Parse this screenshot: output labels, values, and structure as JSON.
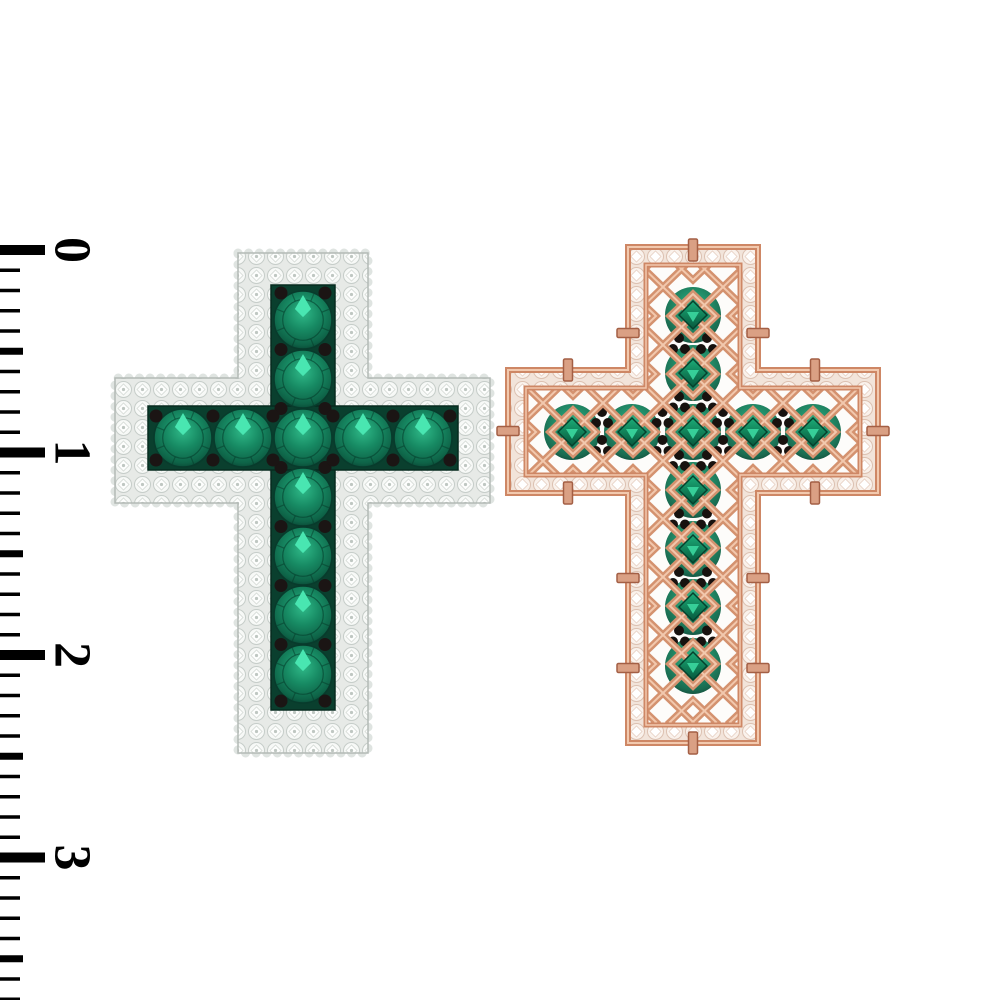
{
  "meta": {
    "description": "3D product render of a cross pendant shown front and back beside a vertical centimeter ruler on a white background",
    "canvas": {
      "width": 1000,
      "height": 1000,
      "background": "#ffffff"
    }
  },
  "ruler": {
    "labels": [
      "0",
      "1",
      "2",
      "3"
    ],
    "label_y": [
      250,
      452.5,
      655,
      857.5
    ],
    "origin_y": 250,
    "mm_px": 20.25,
    "tick_count": 38,
    "major_len": 45,
    "half_len": 23,
    "minor_len": 20,
    "major_h": 10,
    "half_h": 7,
    "minor_h": 3.5,
    "color": "#000000"
  },
  "front_cross": {
    "name": "white-gold pave cross with emeralds and black diamond accents (front view)",
    "pave_color": "#e7eae7",
    "channel_color": "#0a3f2e",
    "bead_color": "#1b1514",
    "emerald_color": "#178a63",
    "emerald_radius": 29,
    "stone_count": 11,
    "vertical_stones": {
      "x": 303,
      "ys": [
        320,
        379,
        438,
        497,
        556,
        615,
        674
      ]
    },
    "horizontal_stones": {
      "y": 438,
      "xs": [
        183,
        243,
        303,
        363,
        423
      ]
    }
  },
  "back_cross": {
    "name": "rose-gold openwork filigree cross (back view) with emeralds visible through lattice windows",
    "metal_mid": "#ce8765",
    "metal_light": "#f2c9ae",
    "metal_dark": "#a35f45",
    "emerald_radius": 28,
    "stone_count": 11,
    "vertical_stones": {
      "x": 693,
      "ys": [
        315,
        373,
        432,
        490,
        549,
        607,
        666
      ]
    },
    "horizontal_stones": {
      "y": 432,
      "xs": [
        572,
        632,
        693,
        753,
        813
      ]
    },
    "tabs": [
      {
        "x": 693,
        "y": 250,
        "o": "v"
      },
      {
        "x": 628,
        "y": 333,
        "o": "h"
      },
      {
        "x": 758,
        "y": 333,
        "o": "h"
      },
      {
        "x": 568,
        "y": 370,
        "o": "v"
      },
      {
        "x": 815,
        "y": 370,
        "o": "v"
      },
      {
        "x": 508,
        "y": 431,
        "o": "h"
      },
      {
        "x": 878,
        "y": 431,
        "o": "h"
      },
      {
        "x": 568,
        "y": 493,
        "o": "v"
      },
      {
        "x": 815,
        "y": 493,
        "o": "v"
      },
      {
        "x": 628,
        "y": 578,
        "o": "h"
      },
      {
        "x": 758,
        "y": 578,
        "o": "h"
      },
      {
        "x": 628,
        "y": 668,
        "o": "h"
      },
      {
        "x": 758,
        "y": 668,
        "o": "h"
      },
      {
        "x": 693,
        "y": 743,
        "o": "v"
      }
    ]
  }
}
